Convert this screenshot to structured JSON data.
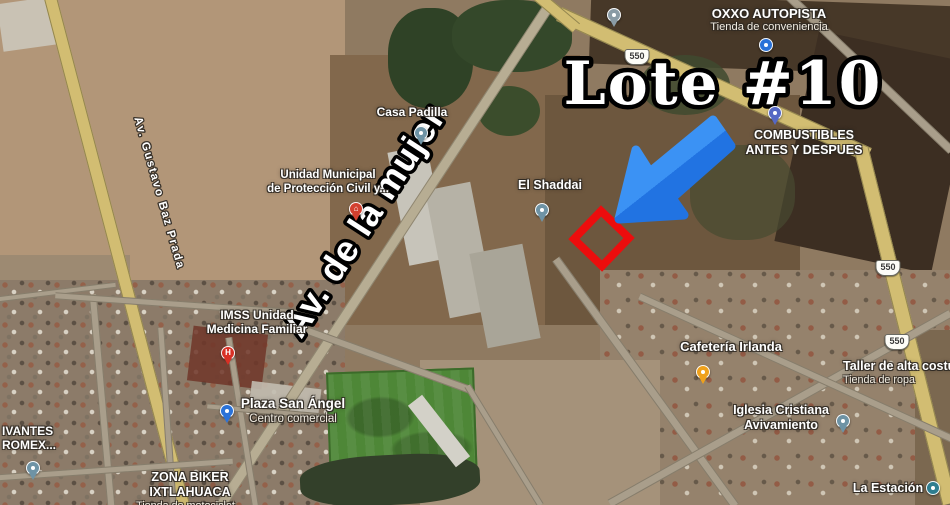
{
  "annotation": {
    "lote_label": "Lote #10",
    "arrow": {
      "color_light": "#3b92f4",
      "color_dark": "#2173e2"
    },
    "lot_outline_color": "#ec0d0d"
  },
  "streets": {
    "mujer": {
      "text": "Av. de la mujer"
    },
    "gustavo": {
      "text": "Av. Gustavo Baz Prada"
    }
  },
  "badges": [
    {
      "label": "550",
      "x": 637,
      "y": 57
    },
    {
      "label": "550",
      "x": 888,
      "y": 268
    },
    {
      "label": "550",
      "x": 897,
      "y": 342
    }
  ],
  "places": [
    {
      "id": "oxxo-autopista",
      "lines": [
        "OXXO AUTOPISTA"
      ],
      "subs": [
        "Tienda de conveniencia"
      ],
      "x": 769,
      "y": 6,
      "size": 13,
      "pin": {
        "shape": "circle",
        "color": "#2a72d8",
        "x": 766,
        "y": 45,
        "name": "convenience-store-pin"
      }
    },
    {
      "id": "store-top",
      "x": 614,
      "y": 2,
      "size": 0,
      "pin": {
        "shape": "teardrop",
        "color": "#8a9ba5",
        "x": 614,
        "y": 22,
        "name": "store-pin"
      }
    },
    {
      "id": "combustibles",
      "lines": [
        "COMBUSTIBLES",
        "ANTES Y DESPUES"
      ],
      "x": 804,
      "y": 128,
      "size": 12.5,
      "pin": {
        "shape": "teardrop",
        "color": "#5568c4",
        "x": 775,
        "y": 120,
        "name": "gas-station-pin"
      }
    },
    {
      "id": "casa-padilla",
      "lines": [
        "Casa Padilla"
      ],
      "x": 412,
      "y": 105,
      "size": 12,
      "pin": {
        "shape": "teardrop",
        "color": "#6e93a5",
        "x": 421,
        "y": 140,
        "name": "poi-pin-casa-padilla"
      }
    },
    {
      "id": "el-shaddai",
      "lines": [
        "El Shaddai"
      ],
      "x": 550,
      "y": 178,
      "size": 12.5,
      "pin": {
        "shape": "teardrop",
        "color": "#6e93a5",
        "x": 542,
        "y": 217,
        "name": "poi-pin-el-shaddai"
      }
    },
    {
      "id": "proteccion-civil",
      "lines": [
        "Unidad Municipal",
        "de Protección Civil y..."
      ],
      "x": 328,
      "y": 169,
      "size": 11.5,
      "pin": {
        "shape": "teardrop",
        "color": "#d3402f",
        "x": 356,
        "y": 216,
        "glyph": "⌂",
        "name": "civic-building-pin"
      }
    },
    {
      "id": "imss",
      "lines": [
        "IMSS Unidad",
        "Medicina Familiar"
      ],
      "x": 257,
      "y": 308,
      "size": 12,
      "pin": {
        "shape": "teardrop",
        "color": "#d83025",
        "x": 228,
        "y": 360,
        "glyph": "H",
        "name": "hospital-pin"
      }
    },
    {
      "id": "plaza-san-angel",
      "lines": [
        "Plaza San Ángel"
      ],
      "subs": [
        "Centro comercial"
      ],
      "x": 293,
      "y": 396,
      "size": 13.5,
      "pin": {
        "shape": "teardrop",
        "color": "#2a72d8",
        "x": 227,
        "y": 418,
        "name": "shopping-mall-pin"
      }
    },
    {
      "id": "zona-biker",
      "lines": [
        "ZONA BIKER",
        "IXTLAHUACA"
      ],
      "subs": [
        "Tienda de motociclet..."
      ],
      "x": 190,
      "y": 470,
      "size": 12.5
    },
    {
      "id": "edge-partial",
      "lines": [
        "IVANTES",
        "ROMEX..."
      ],
      "x": 2,
      "y": 424,
      "size": 12,
      "align": "left",
      "pin": {
        "shape": "teardrop",
        "color": "#6e93a5",
        "x": 33,
        "y": 475,
        "name": "poi-pin-left-edge"
      }
    },
    {
      "id": "cafeteria-irlanda",
      "lines": [
        "Cafetería Irlanda"
      ],
      "x": 731,
      "y": 339,
      "size": 13,
      "pin": {
        "shape": "teardrop",
        "color": "#efa11c",
        "x": 703,
        "y": 379,
        "name": "cafe-pin"
      }
    },
    {
      "id": "taller",
      "lines": [
        "Taller de alta costu"
      ],
      "subs": [
        "Tienda de ropa"
      ],
      "x": 843,
      "y": 359,
      "size": 12.5,
      "align": "left"
    },
    {
      "id": "iglesia",
      "lines": [
        "Iglesia Cristiana",
        "Avivamiento"
      ],
      "x": 781,
      "y": 403,
      "size": 12.5,
      "pin": {
        "shape": "teardrop",
        "color": "#6e93a5",
        "x": 843,
        "y": 428,
        "name": "church-pin"
      }
    },
    {
      "id": "la-estacion",
      "lines": [
        "La Estación"
      ],
      "x": 888,
      "y": 481,
      "size": 12.5,
      "pin": {
        "shape": "circle",
        "color": "#2e7d8f",
        "x": 933,
        "y": 488,
        "name": "poi-pin-la-estacion"
      }
    }
  ]
}
